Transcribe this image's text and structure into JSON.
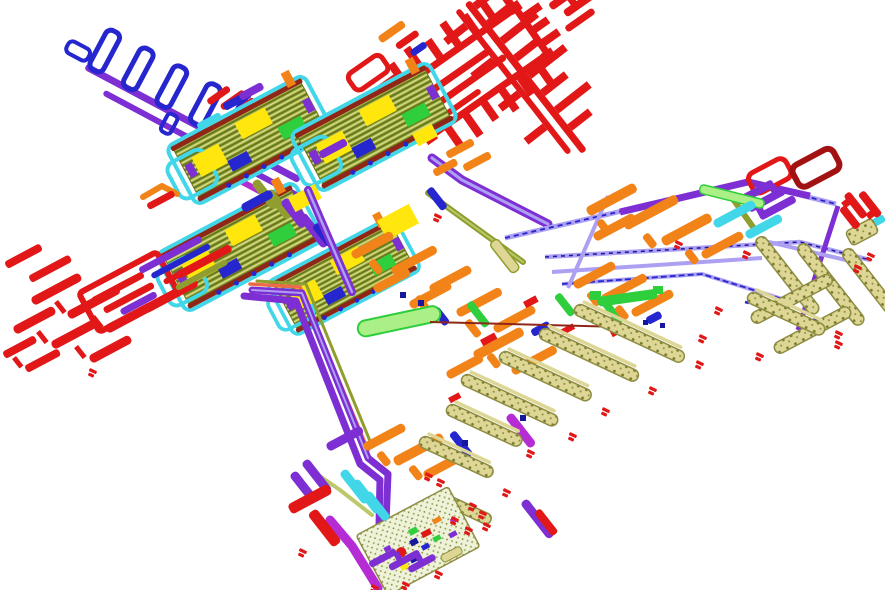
{
  "figure": {
    "name": "integrated-circuit-layout",
    "description": "Rotated CAD view of an integrated-circuit layout on a white canvas",
    "background": "#ffffff"
  },
  "palette": {
    "red": "#e21717",
    "dark_red": "#a31212",
    "maroon": "#8e2717",
    "salmon": "#ee6a48",
    "orange": "#f28318",
    "yellow": "#ffe70d",
    "olive": "#8f9e2f",
    "olive_dark": "#68761d",
    "olive_light": "#bcc96a",
    "green": "#2fce3c",
    "light_green": "#abef87",
    "cyan": "#41d7e8",
    "sky": "#9fe6f2",
    "blue": "#2526cd",
    "navy": "#17179c",
    "purple": "#7d2fd3",
    "lavender": "#ad9ff2",
    "magenta": "#b52cd5",
    "khaki": "#ddd694",
    "khaki_dark": "#8d8d42",
    "khaki_dot": "#79792f",
    "hatch_bg": "#a9b44b",
    "hatch_line": "#67781c",
    "hatch_hi": "#dde393",
    "stipple_bg": "#eef2d9",
    "stipple_dot": "#9cab5e",
    "white": "#ffffff"
  },
  "regions": [
    {
      "name": "meander-stub-line",
      "layers": "blue, purple"
    },
    {
      "name": "bias-comb-top",
      "layers": "red"
    },
    {
      "name": "bias-comb-band-upper-right",
      "layers": "red"
    },
    {
      "name": "bias-comb-left",
      "layers": "red"
    },
    {
      "name": "amplifier-cell-row-upper",
      "layers": "olive, cyan, yellow"
    },
    {
      "name": "amplifier-cell-row-lower",
      "layers": "olive, cyan, yellow"
    },
    {
      "name": "purple-bus-main",
      "layers": "purple, lavender"
    },
    {
      "name": "center-routing-web",
      "layers": "orange, purple, blue, green"
    },
    {
      "name": "right-bus-frame",
      "layers": "lavender, orange, cyan, red"
    },
    {
      "name": "pad-ladder-fan",
      "layers": "khaki"
    },
    {
      "name": "pad-ladder-cluster-right",
      "layers": "khaki"
    },
    {
      "name": "bottom-logic-block",
      "layers": "pale-green, mixed"
    },
    {
      "name": "red-markers",
      "layers": "red"
    }
  ]
}
